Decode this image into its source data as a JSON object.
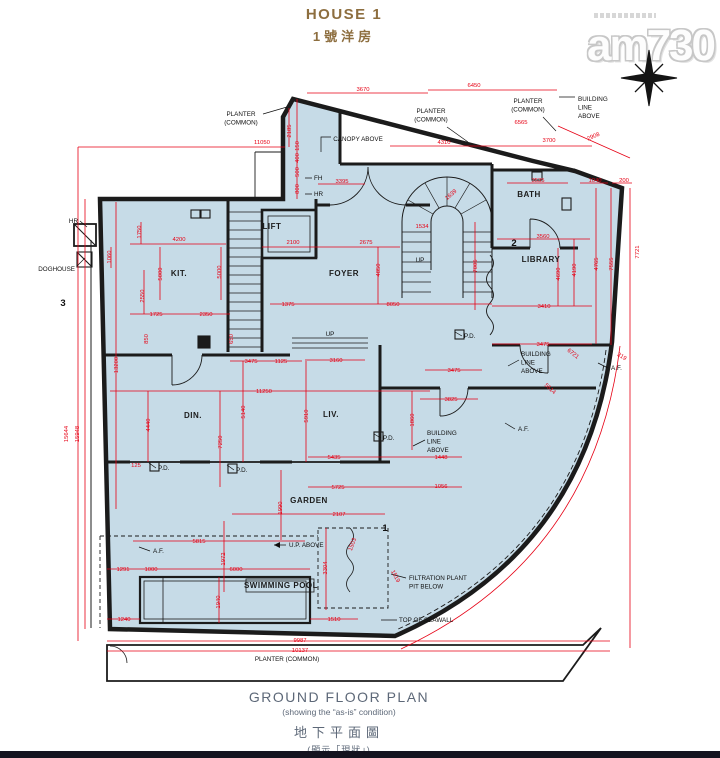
{
  "header": {
    "title": "HOUSE 1",
    "subtitle": "1號洋房"
  },
  "logo": {
    "brand": "am730"
  },
  "footer": {
    "title": "GROUND FLOOR PLAN",
    "subtitle": "(showing the “as-is” condition)",
    "title_zh": "地下平面圖",
    "subtitle_zh": "(顯示「現狀」)"
  },
  "colors": {
    "plan_fill": "#c6dbe7",
    "dimension_red": "#e60014",
    "wall_black": "#1b1b1b",
    "title_gold": "#8d6e3f",
    "footer_gray": "#5d6878",
    "bottom_bar": "#14131f"
  },
  "plan": {
    "rooms": [
      [
        "KIT.",
        179,
        276
      ],
      [
        "FOYER",
        344,
        276
      ],
      [
        "BATH",
        529,
        197
      ],
      [
        "LIBRARY",
        541,
        262
      ],
      [
        "DIN.",
        193,
        418
      ],
      [
        "LIV.",
        331,
        417
      ],
      [
        "GARDEN",
        309,
        503
      ],
      [
        "SWIMMING POOL",
        281,
        588
      ],
      [
        "LIFT",
        272,
        229
      ]
    ],
    "annotations": [
      {
        "lines": [
          "PLANTER",
          "(COMMON)"
        ],
        "x": 241,
        "y": 116,
        "a": "middle"
      },
      {
        "lines": [
          "CANOPY ABOVE"
        ],
        "x": 358,
        "y": 141,
        "a": "middle"
      },
      {
        "lines": [
          "PLANTER",
          "(COMMON)"
        ],
        "x": 431,
        "y": 113,
        "a": "middle"
      },
      {
        "lines": [
          "PLANTER",
          "(COMMON)"
        ],
        "x": 528,
        "y": 103,
        "a": "middle"
      },
      {
        "lines": [
          "BUILDING",
          "LINE",
          "ABOVE"
        ],
        "x": 578,
        "y": 101,
        "a": "start"
      },
      {
        "lines": [
          "FH"
        ],
        "x": 314,
        "y": 180,
        "a": "start"
      },
      {
        "lines": [
          "HR"
        ],
        "x": 314,
        "y": 196,
        "a": "start"
      },
      {
        "lines": [
          "HR"
        ],
        "x": 78,
        "y": 223,
        "a": "end"
      },
      {
        "lines": [
          "DOGHOUSE"
        ],
        "x": 75,
        "y": 271,
        "a": "end"
      },
      {
        "lines": [
          "BUILDING",
          "LINE",
          "ABOVE"
        ],
        "x": 521,
        "y": 356,
        "a": "start"
      },
      {
        "lines": [
          "BUILDING",
          "LINE",
          "ABOVE"
        ],
        "x": 427,
        "y": 435,
        "a": "start"
      },
      {
        "lines": [
          "A.F."
        ],
        "x": 611,
        "y": 370,
        "a": "start"
      },
      {
        "lines": [
          "A.F."
        ],
        "x": 518,
        "y": 431,
        "a": "start"
      },
      {
        "lines": [
          "A.F."
        ],
        "x": 153,
        "y": 553,
        "a": "start"
      },
      {
        "lines": [
          "P.D."
        ],
        "x": 158,
        "y": 470,
        "a": "start"
      },
      {
        "lines": [
          "P.D."
        ],
        "x": 236,
        "y": 472,
        "a": "start"
      },
      {
        "lines": [
          "P.D."
        ],
        "x": 464,
        "y": 338,
        "a": "start"
      },
      {
        "lines": [
          "P.D."
        ],
        "x": 383,
        "y": 440,
        "a": "start"
      },
      {
        "lines": [
          "U.P. ABOVE"
        ],
        "x": 289,
        "y": 547,
        "a": "start"
      },
      {
        "lines": [
          "FILTRATION PLANT",
          "PIT BELOW"
        ],
        "x": 409,
        "y": 580,
        "a": "start"
      },
      {
        "lines": [
          "TOP OF SEAWALL"
        ],
        "x": 399,
        "y": 622,
        "a": "start"
      },
      {
        "lines": [
          "PLANTER (COMMON)"
        ],
        "x": 287,
        "y": 661,
        "a": "middle"
      },
      {
        "lines": [
          "UP"
        ],
        "x": 330,
        "y": 336,
        "a": "middle"
      },
      {
        "lines": [
          "UP"
        ],
        "x": 420,
        "y": 262,
        "a": "middle"
      },
      {
        "lines": [
          "3"
        ],
        "x": 63,
        "y": 306,
        "a": "middle",
        "big": true
      },
      {
        "lines": [
          "2"
        ],
        "x": 514,
        "y": 246,
        "a": "middle",
        "big": true
      },
      {
        "lines": [
          "1"
        ],
        "x": 385,
        "y": 531,
        "a": "middle",
        "big": true
      }
    ],
    "dimensions": [
      [
        "3670",
        363,
        91,
        0
      ],
      [
        "6450",
        474,
        87,
        0
      ],
      [
        "11050",
        262,
        144,
        0
      ],
      [
        "4310",
        444,
        144,
        0
      ],
      [
        "3700",
        549,
        142,
        0
      ],
      [
        "6565",
        521,
        124,
        0
      ],
      [
        "2908",
        594,
        138,
        -23
      ],
      [
        "2185",
        291,
        131,
        -90
      ],
      [
        "150",
        299,
        146,
        -90
      ],
      [
        "400",
        299,
        158,
        -90
      ],
      [
        "500",
        299,
        172,
        -90
      ],
      [
        "800",
        299,
        189,
        -90
      ],
      [
        "3395",
        342,
        183,
        0
      ],
      [
        "3535",
        538,
        182,
        0
      ],
      [
        "1040",
        595,
        182,
        0
      ],
      [
        "200",
        624,
        182,
        0
      ],
      [
        "1750",
        141,
        232,
        -90
      ],
      [
        "1060",
        111,
        257,
        -90
      ],
      [
        "4200",
        179,
        241,
        0
      ],
      [
        "5000",
        162,
        274,
        -90
      ],
      [
        "5000",
        221,
        272,
        -90
      ],
      [
        "2100",
        293,
        244,
        0
      ],
      [
        "2675",
        366,
        244,
        0
      ],
      [
        "1639",
        452,
        196,
        -40
      ],
      [
        "1534",
        422,
        228,
        0
      ],
      [
        "7005",
        477,
        266,
        -90
      ],
      [
        "4850",
        380,
        270,
        -90
      ],
      [
        "3560",
        543,
        238,
        0
      ],
      [
        "4190",
        576,
        270,
        -90
      ],
      [
        "4690",
        560,
        274,
        -90
      ],
      [
        "4765",
        598,
        264,
        -90
      ],
      [
        "7555",
        613,
        264,
        -90
      ],
      [
        "7721",
        639,
        252,
        -90
      ],
      [
        "2550",
        144,
        296,
        -90
      ],
      [
        "1725",
        156,
        316,
        0
      ],
      [
        "2350",
        206,
        316,
        0
      ],
      [
        "1375",
        288,
        306,
        0
      ],
      [
        "8050",
        393,
        306,
        0
      ],
      [
        "3410",
        544,
        308,
        0
      ],
      [
        "850",
        148,
        339,
        -90
      ],
      [
        "650",
        233,
        339,
        -90
      ],
      [
        "3475",
        251,
        363,
        0
      ],
      [
        "1125",
        281,
        363,
        0
      ],
      [
        "3160",
        336,
        362,
        0
      ],
      [
        "3475",
        454,
        372,
        0
      ],
      [
        "3475",
        543,
        346,
        0
      ],
      [
        "13200",
        118,
        365,
        -90
      ],
      [
        "15644",
        68,
        434,
        -90
      ],
      [
        "15948",
        79,
        434,
        -90
      ],
      [
        "11250",
        264,
        393,
        0
      ],
      [
        "5140",
        245,
        412,
        -90
      ],
      [
        "4440",
        150,
        425,
        -90
      ],
      [
        "7250",
        222,
        442,
        -90
      ],
      [
        "5910",
        308,
        416,
        -90
      ],
      [
        "3825",
        451,
        401,
        0
      ],
      [
        "1860",
        414,
        420,
        -90
      ],
      [
        "125",
        136,
        467,
        0
      ],
      [
        "5435",
        334,
        459,
        0
      ],
      [
        "1448",
        441,
        459,
        0
      ],
      [
        "5725",
        338,
        489,
        0
      ],
      [
        "1056",
        441,
        488,
        0
      ],
      [
        "6721",
        572,
        355,
        38
      ],
      [
        "5614",
        549,
        390,
        42
      ],
      [
        "319",
        621,
        358,
        30
      ],
      [
        "2107",
        339,
        516,
        0
      ],
      [
        "1990",
        282,
        508,
        -90
      ],
      [
        "3304",
        327,
        568,
        -90
      ],
      [
        "1503",
        354,
        545,
        -70
      ],
      [
        "1519",
        394,
        577,
        62
      ],
      [
        "5815",
        199,
        543,
        0
      ],
      [
        "1972",
        225,
        559,
        -90
      ],
      [
        "1291",
        123,
        571,
        0
      ],
      [
        "1000",
        151,
        571,
        0
      ],
      [
        "6000",
        236,
        571,
        0
      ],
      [
        "1940",
        220,
        602,
        -90
      ],
      [
        "1240",
        124,
        621,
        0
      ],
      [
        "1510",
        334,
        621,
        0
      ],
      [
        "9987",
        300,
        642,
        0
      ],
      [
        "10137",
        300,
        652,
        0
      ]
    ]
  }
}
